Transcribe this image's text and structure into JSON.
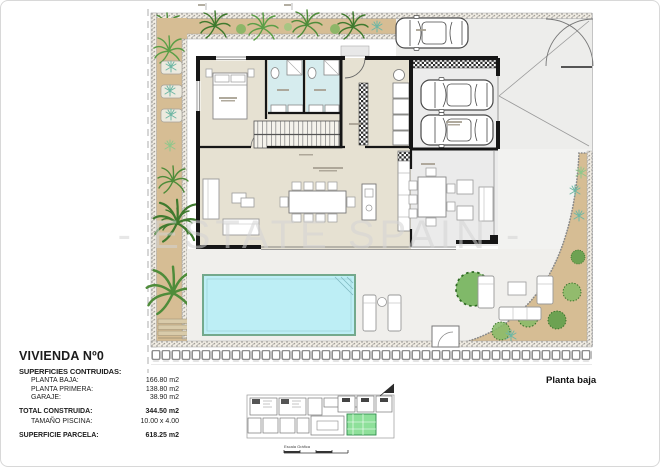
{
  "watermark": "- ESTATE SPAIN -",
  "title_block": {
    "title": "VIVIENDA Nº0",
    "subtitle": "SUPERFICIES CONTRUIDAS:",
    "rows": [
      {
        "label": "PLANTA BAJA:",
        "value": "166.80 m2"
      },
      {
        "label": "PLANTA PRIMERA:",
        "value": "138.80 m2"
      },
      {
        "label": "GARAJE:",
        "value": "38.90 m2"
      },
      {
        "label": "TOTAL CONSTRUIDA:",
        "value": "344.50 m2"
      },
      {
        "label": "TAMAÑO PISCINA:",
        "value": "10.00 x 4.00"
      },
      {
        "label": "SUPERFICIE PARCELA:",
        "value": "618.25 m2"
      }
    ]
  },
  "floor_label": "Planta baja",
  "inset": {
    "scale_label": "Escala Gráfica"
  },
  "colors": {
    "floor_beige": "#e6e1d2",
    "bath_blue": "#d6ecee",
    "garden_tan": "#d6bd94",
    "pool_cyan": "#bdeef5",
    "pool_edge": "#74a98c",
    "highlight_green": "#8ee09a",
    "wall_black": "#161616",
    "fence_gray": "#8f8f8f"
  }
}
